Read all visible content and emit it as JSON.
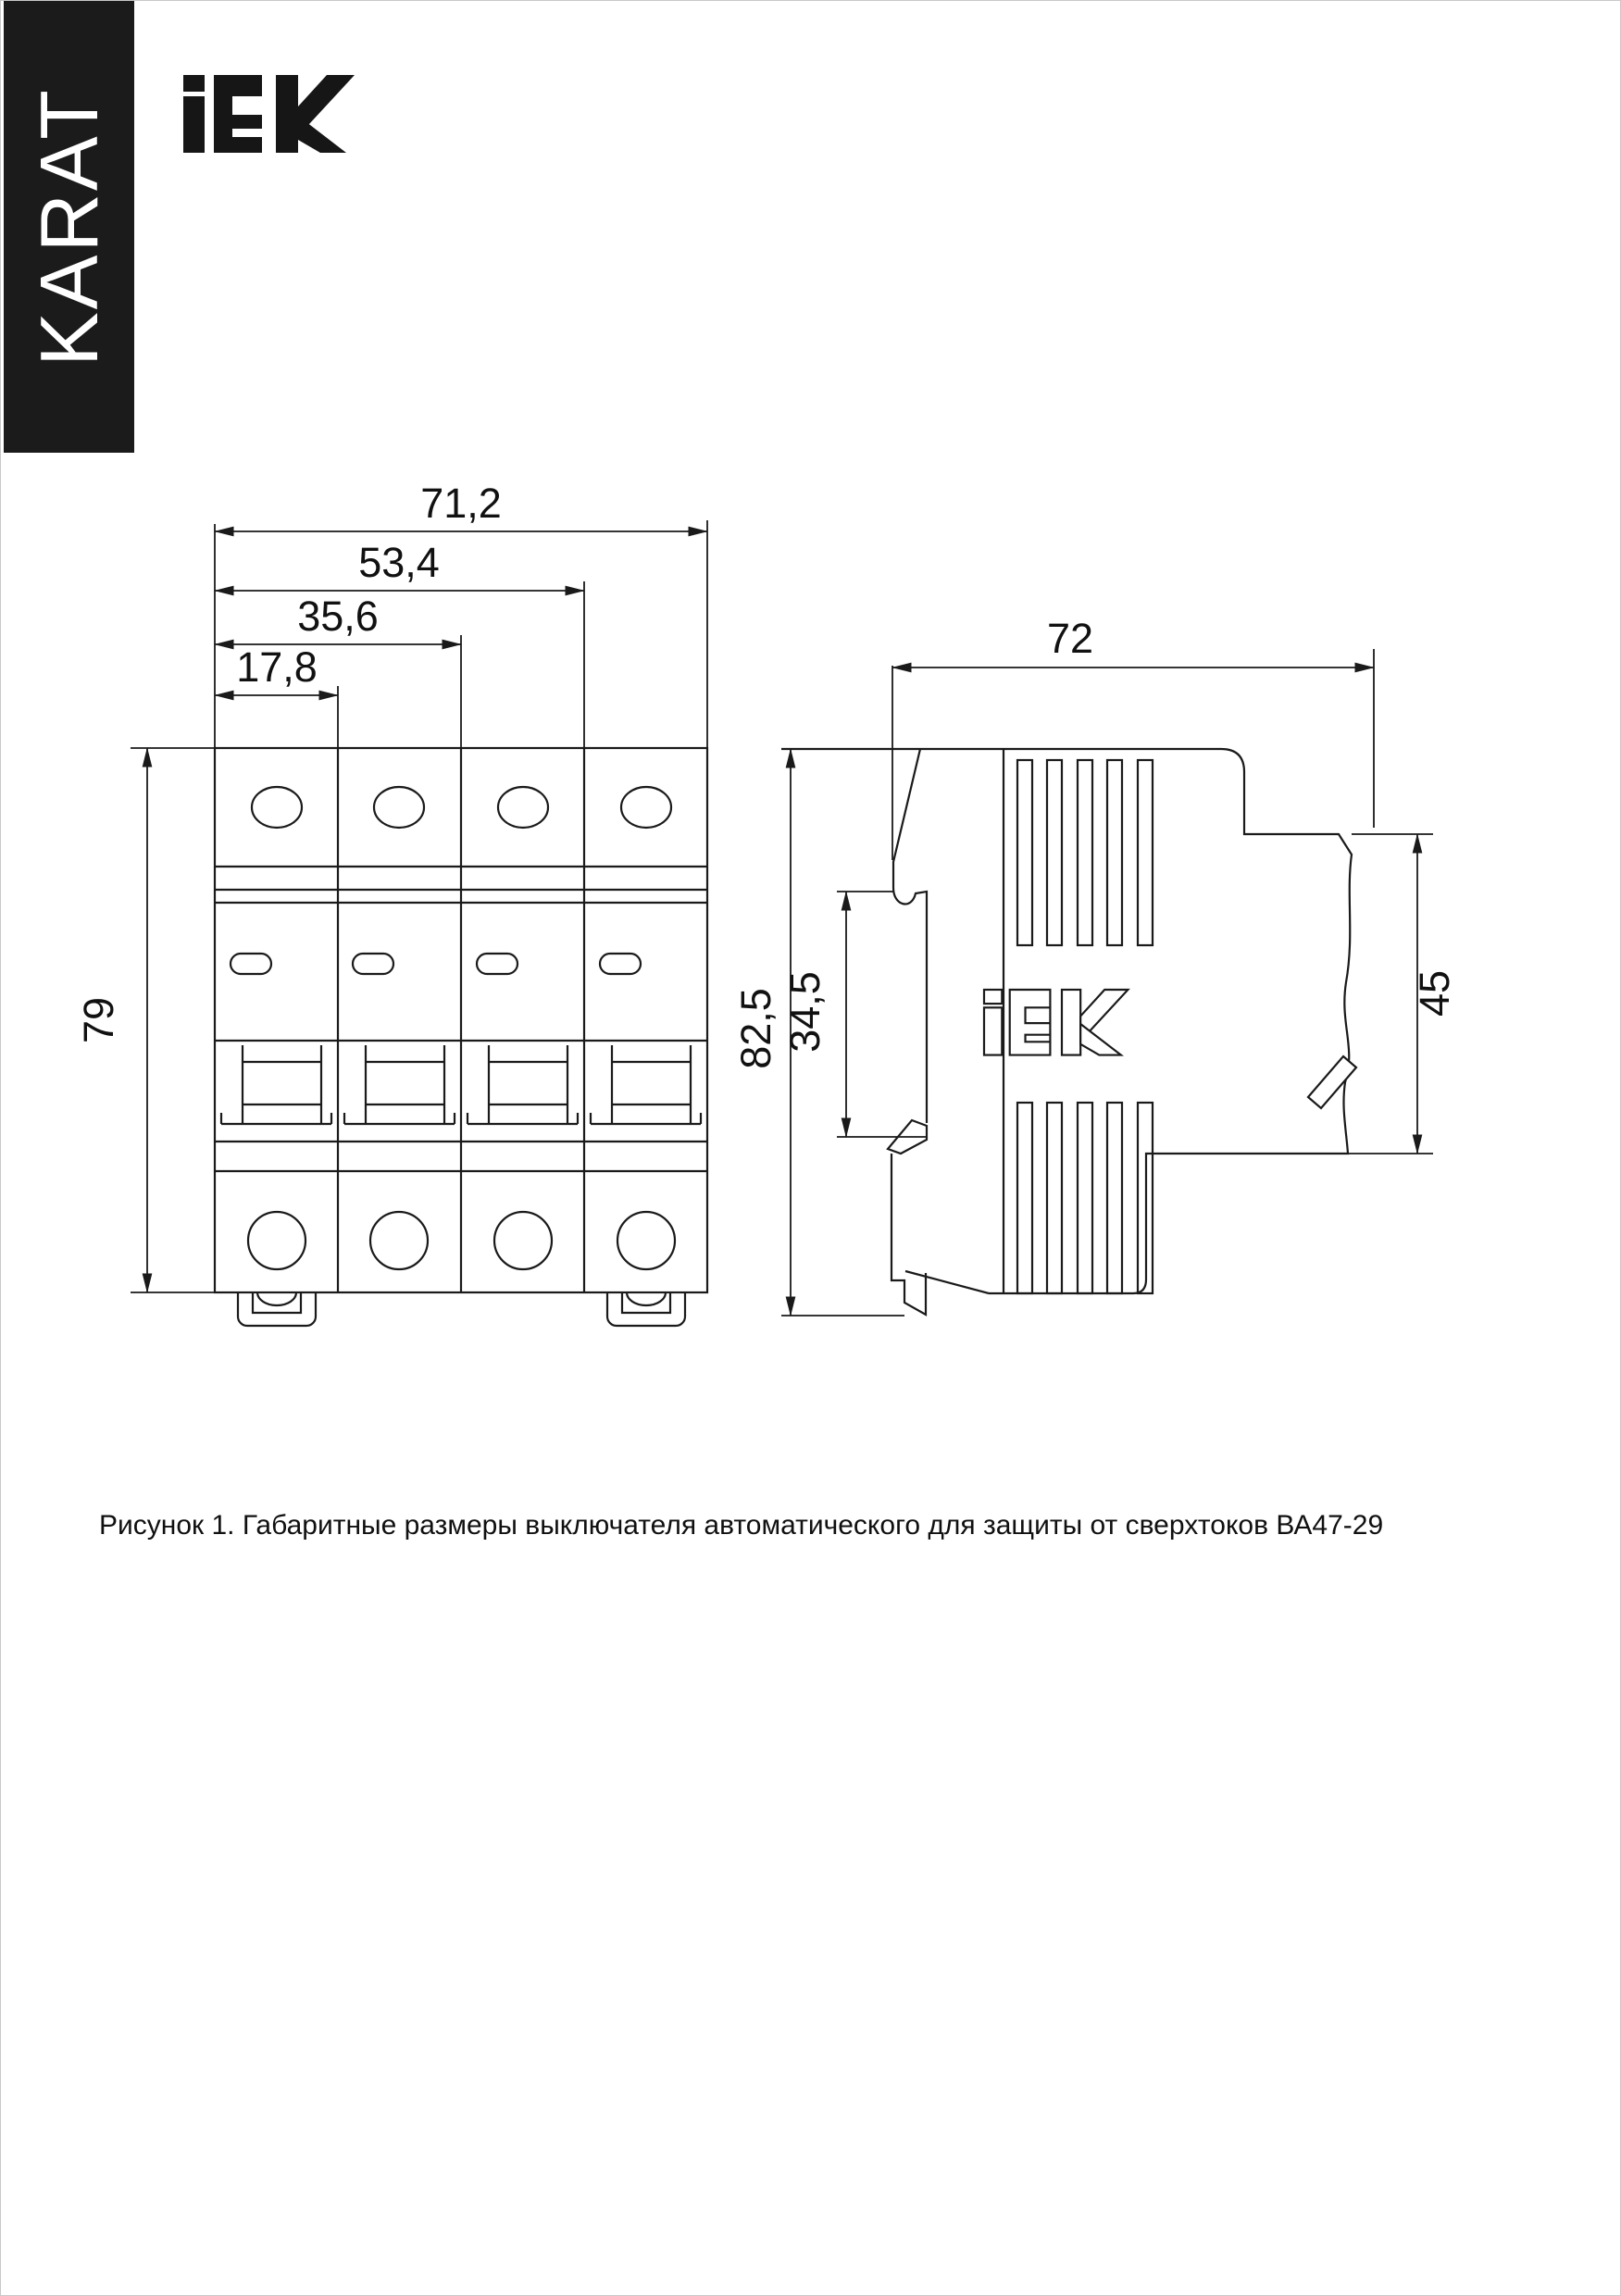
{
  "page": {
    "background": "#ffffff",
    "border_color": "#c8c8c8"
  },
  "sidebar_banner": {
    "text": "KARAT",
    "bg": "#1b1b1b",
    "text_color": "#ffffff"
  },
  "brand": {
    "logo_icon": "iek-logo",
    "letters": "IEK",
    "color": "#161616"
  },
  "figure": {
    "front_view": {
      "name": "front view, 4-pole circuit breaker",
      "poles": 4,
      "dim_width_total": "71,2",
      "dim_width_3poles": "53,4",
      "dim_width_2poles": "35,6",
      "dim_width_1pole": "17,8",
      "dim_height": "79"
    },
    "side_view": {
      "name": "side view, circuit breaker profile",
      "dim_depth": "72",
      "dim_height": "82,5",
      "dim_din_zone": "34,5",
      "dim_terminal_zone": "45",
      "embossed_logo": "IEK"
    }
  },
  "caption": {
    "text": "Рисунок 1. Габаритные размеры выключателя автоматического для защиты от сверхтоков ВА47-29"
  }
}
